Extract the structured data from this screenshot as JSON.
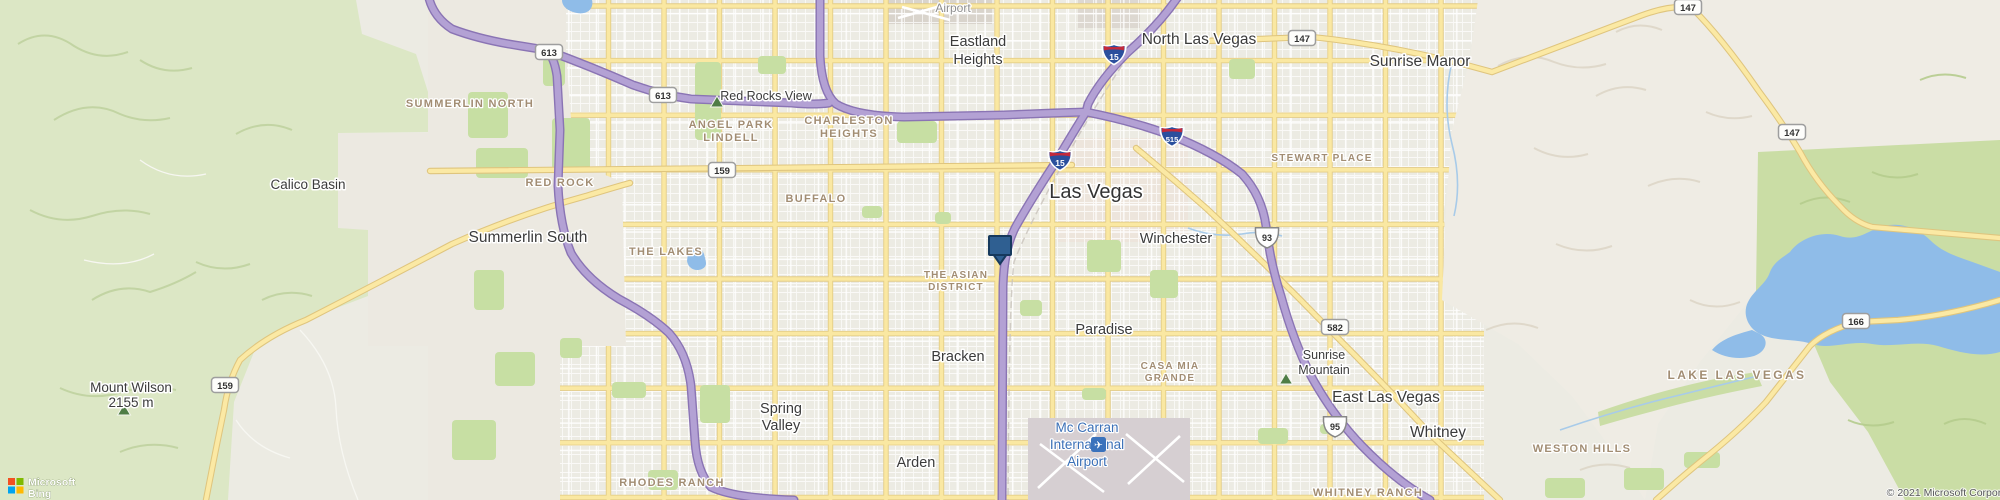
{
  "map": {
    "background": "#ECEBE3",
    "urban_clip": "428,0 1480,0 1456,120 1444,210 1446,300 1520,346 1576,398 1622,462 1648,500 428,500",
    "park_fill": "#C7DFA3",
    "water_fill": "#8FBCE8",
    "marker_fill": "#2F5F91",
    "marker_stroke": "#16395D",
    "peak_fill": "#4F7D46"
  },
  "areas_under": [
    {
      "name": "downtown-tint",
      "d": "M1058,138 L1188,138 L1188,242 L1058,242 Z",
      "fill": "#EEDFD5",
      "opacity": 0.5
    },
    {
      "name": "airport-north-las-vegas",
      "d": "M884,0 L992,0 L992,24 L884,24 Z",
      "fill": "#D9D4CC",
      "opacity": 1
    },
    {
      "name": "industrial-north",
      "d": "M1078,0 L1140,0 L1140,28 L1078,28 Z",
      "fill": "#DDD8D1",
      "opacity": 1
    }
  ],
  "areas_over": [
    {
      "name": "desert-summerlin-north",
      "d": "M428,0 L566,0 L566,52 L572,133 L428,133 Z",
      "fill": "#ECE9E1",
      "opacity": 1
    },
    {
      "name": "desert-summerlin-south",
      "d": "M338,133 L560,133 L560,156 L622,182 L626,346 L368,346 L368,230 L338,228 Z",
      "fill": "#ECE9E1",
      "opacity": 1
    },
    {
      "name": "desert-rhodes",
      "d": "M428,346 L560,346 L560,500 L428,500 Z",
      "fill": "#ECE9E1",
      "opacity": 1
    },
    {
      "name": "green-west-mountains",
      "d": "M0,0 L356,0 L362,34 L416,54 L428,92 L428,132 L338,133 L338,228 L368,230 L368,296 L300,322 L254,352 L234,402 L228,500 L0,500 Z",
      "fill": "#DCE7C5",
      "opacity": 1
    },
    {
      "name": "mountains-east",
      "d": "M1478,0 L2000,0 L2000,140 L1758,152 L1756,292 L1700,362 L1658,424 L1645,500 L1618,458 L1572,396 L1518,344 L1442,300 L1446,208 L1452,130 L1470,58 Z",
      "fill": "#EFECE4",
      "opacity": 1
    },
    {
      "name": "green-east",
      "d": "M1758,152 L2000,140 L2000,500 L1905,500 L1868,432 L1830,382 L1810,335 L1756,292 Z",
      "fill": "#CADDA5",
      "opacity": 1
    },
    {
      "name": "green-wash",
      "d": "M1598,412 Q1660,390 1720,378 L1756,372 L1762,386 Q1700,398 1650,412 Q1620,420 1600,426 Z",
      "fill": "#CADDA5",
      "opacity": 1
    }
  ],
  "airport_area": {
    "name": "airport-mccarran",
    "d": "M1028,418 L1190,418 L1190,500 L1028,500 Z",
    "fill": "#D6CFD2"
  },
  "ridges": {
    "rw": [
      "M18,44 q28,-18 56,2 q26,16 54,6",
      "M54,120 q34,-22 66,-6 q24,10 50,4",
      "M30,210 q30,16 62,6 q30,-10 58,-2",
      "M92,300 q28,-18 58,-8 q26,-8 46,-20",
      "M60,388 q30,14 62,4 q28,-8 54,-2",
      "M140,60 q24,16 52,8",
      "M236,134 q28,-16 56,-4",
      "M196,262 q26,12 54,2",
      "M120,452 q28,-12 58,-4",
      "M262,300 q24,-12 50,-4"
    ],
    "rt": [
      "M1498,66 q28,-16 56,-4 q26,10 52,2",
      "M1534,148 q26,14 54,6",
      "M1596,96 q24,-14 50,-6",
      "M1556,244 q28,12 56,2",
      "M1648,186 q26,-12 52,-4",
      "M1690,300 q24,12 50,2",
      "M1486,330 q26,-12 52,-2",
      "M1616,32 q22,-12 46,-2",
      "M1706,112 q22,10 46,4",
      "M1580,470 q24,-10 50,-2"
    ],
    "rg": [
      "M1800,204 q24,-12 50,-2",
      "M1872,172 q22,10 46,2",
      "M1926,282 q24,-10 48,0",
      "M1848,420 q22,10 46,2",
      "M1944,424 q20,-10 42,0",
      "M1920,80 q22,-10 46,-2"
    ]
  },
  "trails": [
    "M300,330 q34,36 36,78 q2,44 22,92",
    "M236,420 q18,28 54,38",
    "M84,260 q40,10 70,-6",
    "M140,160 q30,22 66,14"
  ],
  "streams": [
    "M1452,62 q-10,42 0,82 q10,38 2,72",
    "M1560,430 q64,-22 124,-36 q40,-10 74,-18",
    "M1188,228 q26,10 54,6 q22,-4 40,2"
  ],
  "parks": [
    [
      543,
      58,
      22,
      28
    ],
    [
      552,
      118,
      38,
      52
    ],
    [
      695,
      62,
      26,
      78
    ],
    [
      758,
      56,
      28,
      18
    ],
    [
      897,
      121,
      40,
      22
    ],
    [
      1229,
      59,
      26,
      20
    ],
    [
      1087,
      240,
      34,
      32
    ],
    [
      1150,
      270,
      28,
      28
    ],
    [
      1020,
      300,
      22,
      16
    ],
    [
      862,
      206,
      20,
      12
    ],
    [
      700,
      385,
      30,
      38
    ],
    [
      612,
      382,
      34,
      16
    ],
    [
      560,
      338,
      22,
      20
    ],
    [
      648,
      470,
      30,
      20
    ],
    [
      1082,
      388,
      24,
      12
    ],
    [
      1258,
      428,
      30,
      16
    ],
    [
      1320,
      424,
      18,
      10
    ],
    [
      1624,
      468,
      40,
      22
    ],
    [
      1684,
      452,
      36,
      16
    ],
    [
      935,
      212,
      16,
      12
    ],
    [
      1545,
      478,
      40,
      20
    ],
    [
      468,
      92,
      40,
      46
    ],
    [
      476,
      148,
      52,
      30
    ],
    [
      495,
      352,
      40,
      34
    ],
    [
      452,
      420,
      44,
      40
    ],
    [
      474,
      270,
      30,
      40
    ]
  ],
  "water": [
    {
      "name": "lake-las-vegas",
      "d": "M1790,252 C1800,238 1822,230 1840,236 C1858,242 1868,230 1884,226 C1900,222 1918,228 1930,240 C1944,254 1962,258 1978,264 L2000,272 L2000,352 C1980,358 1958,352 1938,346 C1916,340 1894,348 1872,344 C1850,340 1830,350 1812,344 C1794,338 1776,342 1760,334 C1748,328 1742,314 1748,302 C1754,290 1766,284 1770,272 C1774,262 1782,258 1790,252 Z"
    },
    {
      "name": "lake-arm",
      "d": "M1712,350 C1722,338 1738,334 1752,330 L1760,334 C1770,340 1766,352 1754,356 C1740,360 1724,358 1712,350 Z"
    },
    {
      "name": "the-lakes-pond",
      "d": "M688,252 C694,246 702,248 704,254 C706,262 708,266 702,269 C695,272 688,268 687,261 Z"
    },
    {
      "name": "top-pond",
      "d": "M562,0 L592,0 C594,8 588,15 577,13 C567,11 562,6 562,0 Z"
    }
  ],
  "grid": {
    "v": {
      "from": 442,
      "to": 1444,
      "step": 55.5
    },
    "h": {
      "from": 6,
      "to": 498,
      "step": 54.6
    },
    "x0": 424,
    "x1": 1484,
    "y0": -4,
    "y1": 504
  },
  "named_roads": [
    {
      "name": "charleston-blvd-159",
      "d": "M430,171 L1072,165"
    },
    {
      "name": "blue-diamond-159",
      "d": "M206,500 Q216,448 224,410 Q228,382 240,360 Q266,336 306,320 Q380,282 452,244 Q520,214 586,196 Q612,188 630,183"
    },
    {
      "name": "route-147",
      "d": "M1206,41 L1312,37 Q1400,46 1492,72 Q1556,48 1640,16 Q1672,4 1692,8 Q1722,38 1758,90 Q1782,122 1800,152 Q1816,182 1840,206 Q1854,222 1872,227 L2000,238"
    },
    {
      "name": "route-166",
      "d": "M2000,300 Q1946,316 1898,320 L1858,322 Q1826,330 1810,346 Q1788,374 1766,402 Q1738,432 1700,462 Q1678,480 1656,500"
    },
    {
      "name": "boulder-hwy-582",
      "d": "M1136,148 Q1172,178 1206,208 Q1268,266 1330,330 Q1384,384 1434,438 Q1468,470 1500,500"
    }
  ],
  "railway": "M1128,56 Q1086,120 1064,162 Q1028,226 1014,262 Q1009,300 1008,500",
  "freeways": [
    {
      "name": "us95-i515",
      "d": "M820,-6 L820,56 Q822,92 836,104 Q856,116 904,117 L1004,115 Q1052,113 1086,112 Q1132,121 1170,135 Q1216,153 1242,174 Q1262,196 1266,226 Q1270,262 1281,296 Q1293,340 1311,376 Q1333,416 1362,446 Q1396,481 1430,500"
    },
    {
      "name": "i15",
      "d": "M1180,-6 Q1160,24 1128,52 Q1100,80 1088,104 L1086,112 Q1068,141 1057,160 Q1030,201 1015,228 Q1004,250 1003,286 L1002,500"
    },
    {
      "name": "cc215-beltway",
      "d": "M428,-6 Q432,16 452,29 Q481,40 521,46 L546,50 Q554,56 557,76 L560,130 L558,186 Q560,226 571,253 Q586,279 619,299 Q651,316 669,333 Q687,353 691,386 L695,441 Q697,472 711,487 Q733,498 794,500"
    },
    {
      "name": "summerlin-pkwy-613",
      "d": "M546,50 Q592,67 633,85 Q661,95 691,99 L792,103 Q814,105 829,103"
    }
  ],
  "runways_mccarran": [
    [
      1038,
      488,
      1096,
      434
    ],
    [
      1040,
      444,
      1104,
      492
    ],
    [
      1126,
      434,
      1184,
      482
    ],
    [
      1128,
      484,
      1180,
      436
    ]
  ],
  "runways_nlv": [
    [
      898,
      18,
      944,
      5
    ],
    [
      902,
      7,
      950,
      20
    ]
  ],
  "labels": [
    {
      "t": "Calico Basin",
      "x": 308,
      "y": 189,
      "c": "c13"
    },
    {
      "t": "Summerlin South",
      "x": 528,
      "y": 242,
      "c": "c15"
    },
    {
      "t": "North Las Vegas",
      "x": 1199,
      "y": 44,
      "c": "c15"
    },
    {
      "t": "Sunrise Manor",
      "x": 1420,
      "y": 66,
      "c": "c15"
    },
    {
      "ls": [
        "Eastland",
        "Heights"
      ],
      "x": 978,
      "y": 46,
      "lh": 18,
      "c": "c14"
    },
    {
      "t": "Las Vegas",
      "x": 1096,
      "y": 198,
      "c": "lv"
    },
    {
      "t": "Winchester",
      "x": 1176,
      "y": 243,
      "c": "c14"
    },
    {
      "t": "Paradise",
      "x": 1104,
      "y": 334,
      "c": "c14"
    },
    {
      "t": "Bracken",
      "x": 958,
      "y": 361,
      "c": "c14"
    },
    {
      "ls": [
        "Spring",
        "Valley"
      ],
      "x": 781,
      "y": 413,
      "lh": 17,
      "c": "c14"
    },
    {
      "t": "Arden",
      "x": 916,
      "y": 467,
      "c": "c14"
    },
    {
      "t": "East Las Vegas",
      "x": 1386,
      "y": 402,
      "c": "c15"
    },
    {
      "t": "Whitney",
      "x": 1438,
      "y": 437,
      "c": "c15"
    },
    {
      "ls": [
        "Sunrise",
        "Mountain"
      ],
      "x": 1324,
      "y": 359,
      "lh": 15,
      "c": "c12"
    },
    {
      "ls": [
        "Mount Wilson",
        "2155 m"
      ],
      "x": 131,
      "y": 392,
      "lh": 15,
      "c": "c13",
      "a": "start"
    },
    {
      "t": "Red Rocks View",
      "x": 766,
      "y": 100,
      "c": "c12"
    },
    {
      "t": "Airport",
      "x": 953,
      "y": 12,
      "c": "gray"
    },
    {
      "ls": [
        "Mc Carran",
        "International",
        "Airport"
      ],
      "x": 1087,
      "y": 432,
      "lh": 17,
      "c": "blue",
      "a": "end"
    },
    {
      "t": "SUMMERLIN NORTH",
      "x": 470,
      "y": 107,
      "c": "d"
    },
    {
      "t": "RED ROCK",
      "x": 560,
      "y": 186,
      "c": "d"
    },
    {
      "ls": [
        "ANGEL PARK",
        "LINDELL"
      ],
      "x": 731,
      "y": 128,
      "lh": 13,
      "c": "d"
    },
    {
      "ls": [
        "CHARLESTON",
        "HEIGHTS"
      ],
      "x": 849,
      "y": 124,
      "lh": 13,
      "c": "d"
    },
    {
      "t": "BUFFALO",
      "x": 816,
      "y": 202,
      "c": "d"
    },
    {
      "t": "THE LAKES",
      "x": 666,
      "y": 255,
      "c": "d"
    },
    {
      "ls": [
        "THE ASIAN",
        "DISTRICT"
      ],
      "x": 956,
      "y": 278,
      "lh": 12,
      "c": "d2"
    },
    {
      "ls": [
        "CASA MIA",
        "GRANDE"
      ],
      "x": 1170,
      "y": 369,
      "lh": 12,
      "c": "d2"
    },
    {
      "t": "STEWART PLACE",
      "x": 1322,
      "y": 161,
      "c": "d2"
    },
    {
      "t": "RHODES RANCH",
      "x": 672,
      "y": 486,
      "c": "d"
    },
    {
      "t": "WHITNEY RANCH",
      "x": 1368,
      "y": 496,
      "c": "d"
    },
    {
      "t": "WESTON HILLS",
      "x": 1582,
      "y": 452,
      "c": "d"
    },
    {
      "t": "LAKE LAS VEGAS",
      "x": 1737,
      "y": 379,
      "c": "lake"
    }
  ],
  "shields": [
    {
      "k": "i",
      "t": "15",
      "x": 1114,
      "y": 54
    },
    {
      "k": "i",
      "t": "15",
      "x": 1060,
      "y": 160
    },
    {
      "k": "i",
      "t": "515",
      "x": 1172,
      "y": 136
    },
    {
      "k": "u",
      "t": "93",
      "x": 1267,
      "y": 237
    },
    {
      "k": "u",
      "t": "95",
      "x": 1335,
      "y": 426
    },
    {
      "k": "s",
      "t": "613",
      "x": 549,
      "y": 52
    },
    {
      "k": "s",
      "t": "613",
      "x": 663,
      "y": 95
    },
    {
      "k": "s",
      "t": "159",
      "x": 722,
      "y": 170
    },
    {
      "k": "s",
      "t": "159",
      "x": 225,
      "y": 385
    },
    {
      "k": "s",
      "t": "147",
      "x": 1302,
      "y": 38
    },
    {
      "k": "s",
      "t": "147",
      "x": 1688,
      "y": 7
    },
    {
      "k": "s",
      "t": "147",
      "x": 1792,
      "y": 132
    },
    {
      "k": "s",
      "t": "582",
      "x": 1335,
      "y": 327
    },
    {
      "k": "s",
      "t": "166",
      "x": 1856,
      "y": 321
    }
  ],
  "peaks": [
    [
      717,
      103
    ],
    [
      1286,
      380
    ],
    [
      124,
      411
    ]
  ],
  "marker": {
    "x": 1000,
    "y": 236,
    "w": 22,
    "h": 19,
    "tip": 9
  },
  "airport_icon": {
    "x": 1091,
    "y": 437,
    "size": 15,
    "glyph": "✈"
  },
  "attribution": {
    "brand_line1": "Microsoft",
    "brand_line2": "Bing",
    "copyright": "© 2021 Microsoft Corporation © 2021 TomTom",
    "logo_colors": [
      "#F25022",
      "#7FBA00",
      "#00A4EF",
      "#FFB900"
    ]
  }
}
